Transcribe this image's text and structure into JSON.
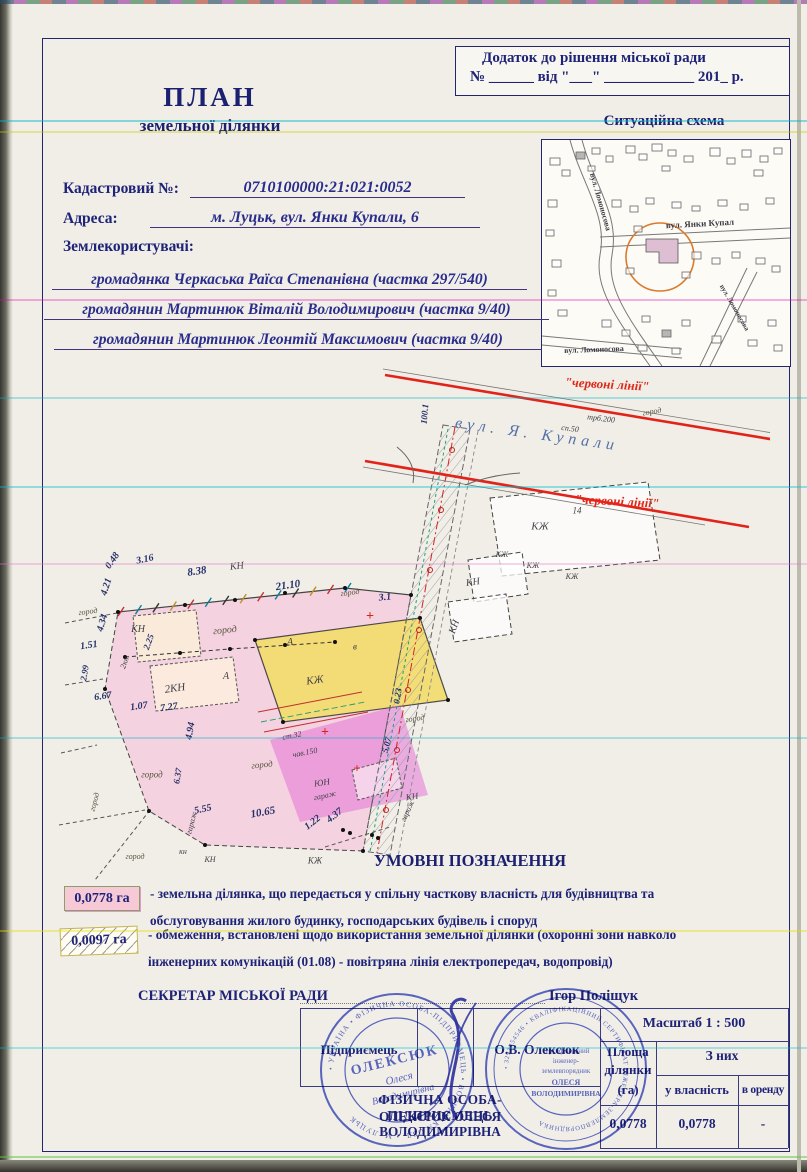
{
  "header": {
    "appendix_line1": "Додаток до рішення міської ради",
    "appendix_line2": "№ ______  від \"___\" ____________ 201_ р.",
    "title": "ПЛАН",
    "subtitle": "земельної ділянки"
  },
  "fields": {
    "cadastral_label": "Кадастровий №:",
    "cadastral_value": "0710100000:21:021:0052",
    "address_label": "Адреса:",
    "address_value": "м. Луцьк, вул. Янки Купали, 6",
    "users_label": "Землекористувачі:",
    "users": [
      "громадянка Черкаська Раїса Степанівна (частка 297/540)",
      "громадянин Мартинюк Віталій Володимирович (частка 9/40)",
      "громадянин Мартинюк Леонтій Максимович (частка 9/40)"
    ]
  },
  "scheme": {
    "title": "Ситуаційна схема",
    "labels": [
      {
        "t": "вул. Ломоносова",
        "x": 58,
        "y": 62,
        "r": 74,
        "s": 8,
        "c": "maplbl"
      },
      {
        "t": "вул. Янки Купал",
        "x": 158,
        "y": 84,
        "r": -3,
        "s": 9,
        "c": "maplbl"
      },
      {
        "t": "вул. Ломоносова",
        "x": 52,
        "y": 210,
        "r": -2,
        "s": 8,
        "c": "maplbl"
      },
      {
        "t": "вул. Ломоносова",
        "x": 192,
        "y": 168,
        "r": 60,
        "s": 7,
        "c": "maplbl"
      }
    ]
  },
  "plan": {
    "labels": [
      {
        "t": "вул. Я. Купали",
        "x": 492,
        "y": 80,
        "r": 8,
        "s": 16,
        "c": "street",
        "sp": 5
      },
      {
        "t": "\"червоні лінії\"",
        "x": 562,
        "y": 29,
        "r": 3,
        "s": 13,
        "c": "red"
      },
      {
        "t": "\"червоні лінії\"",
        "x": 572,
        "y": 146,
        "r": 3,
        "s": 13,
        "c": "red"
      },
      {
        "t": "100.1",
        "x": 380,
        "y": 59,
        "r": -85,
        "s": 9,
        "c": "dim"
      },
      {
        "t": "сп.50",
        "x": 525,
        "y": 74,
        "r": 7,
        "s": 8,
        "c": "lbl"
      },
      {
        "t": "трб.200",
        "x": 556,
        "y": 64,
        "r": 7,
        "s": 8,
        "c": "lbl"
      },
      {
        "t": "0.48",
        "x": 68,
        "y": 206,
        "r": -55,
        "s": 10,
        "c": "dim"
      },
      {
        "t": "3.16",
        "x": 100,
        "y": 205,
        "r": -12,
        "s": 10,
        "c": "dim"
      },
      {
        "t": "8.38",
        "x": 152,
        "y": 217,
        "r": -8,
        "s": 11,
        "c": "dim"
      },
      {
        "t": "4.21",
        "x": 62,
        "y": 232,
        "r": -72,
        "s": 10,
        "c": "dim"
      },
      {
        "t": "4.34",
        "x": 58,
        "y": 268,
        "r": -74,
        "s": 10,
        "c": "dim"
      },
      {
        "t": "21.10",
        "x": 243,
        "y": 231,
        "r": -8,
        "s": 11,
        "c": "dim"
      },
      {
        "t": "3.1",
        "x": 340,
        "y": 243,
        "r": -6,
        "s": 10,
        "c": "dim"
      },
      {
        "t": "КН",
        "x": 192,
        "y": 212,
        "r": -6,
        "s": 10,
        "c": "lbl"
      },
      {
        "t": "1.51",
        "x": 44,
        "y": 291,
        "r": -8,
        "s": 10,
        "c": "dim"
      },
      {
        "t": "2.25",
        "x": 104,
        "y": 287,
        "r": -70,
        "s": 9,
        "c": "dim"
      },
      {
        "t": "2.99",
        "x": 40,
        "y": 318,
        "r": -80,
        "s": 9,
        "c": "dim"
      },
      {
        "t": "6.67",
        "x": 58,
        "y": 342,
        "r": -8,
        "s": 10,
        "c": "dim"
      },
      {
        "t": "1.07",
        "x": 94,
        "y": 352,
        "r": -8,
        "s": 10,
        "c": "dim"
      },
      {
        "t": "7.27",
        "x": 124,
        "y": 353,
        "r": -8,
        "s": 10,
        "c": "dim"
      },
      {
        "t": "4.94",
        "x": 146,
        "y": 376,
        "r": -80,
        "s": 10,
        "c": "dim"
      },
      {
        "t": "6.37",
        "x": 133,
        "y": 421,
        "r": -80,
        "s": 9,
        "c": "dim"
      },
      {
        "t": "5.55",
        "x": 158,
        "y": 455,
        "r": -12,
        "s": 10,
        "c": "dim"
      },
      {
        "t": "10.65",
        "x": 218,
        "y": 458,
        "r": -10,
        "s": 11,
        "c": "dim"
      },
      {
        "t": "1.22",
        "x": 268,
        "y": 468,
        "r": -38,
        "s": 10,
        "c": "dim"
      },
      {
        "t": "4.37",
        "x": 290,
        "y": 461,
        "r": -38,
        "s": 10,
        "c": "dim"
      },
      {
        "t": "5.07",
        "x": 342,
        "y": 390,
        "r": -76,
        "s": 9,
        "c": "dim"
      },
      {
        "t": "0.23",
        "x": 353,
        "y": 341,
        "r": -80,
        "s": 9,
        "c": "dim"
      },
      {
        "t": "КН",
        "x": 93,
        "y": 275,
        "r": 0,
        "s": 10,
        "c": "lbl"
      },
      {
        "t": "2кн",
        "x": 80,
        "y": 308,
        "r": -70,
        "s": 8,
        "c": "lbl"
      },
      {
        "t": "2КН",
        "x": 130,
        "y": 334,
        "r": -8,
        "s": 11,
        "c": "lbl"
      },
      {
        "t": "А",
        "x": 245,
        "y": 288,
        "r": 0,
        "s": 10,
        "c": "lbl"
      },
      {
        "t": "в",
        "x": 310,
        "y": 292,
        "r": 0,
        "s": 9,
        "c": "lbl"
      },
      {
        "t": "А",
        "x": 181,
        "y": 322,
        "r": 0,
        "s": 10,
        "c": "lbl"
      },
      {
        "t": "КЖ",
        "x": 270,
        "y": 326,
        "r": -8,
        "s": 11,
        "c": "lbl"
      },
      {
        "t": "ст.32",
        "x": 247,
        "y": 381,
        "r": -11,
        "s": 8,
        "c": "lbl"
      },
      {
        "t": "чав.150",
        "x": 260,
        "y": 398,
        "r": -11,
        "s": 8,
        "c": "lbl"
      },
      {
        "t": "ЮН",
        "x": 277,
        "y": 428,
        "r": -8,
        "s": 9,
        "c": "lbl"
      },
      {
        "t": "город",
        "x": 43,
        "y": 257,
        "r": -8,
        "s": 8,
        "c": "grn"
      },
      {
        "t": "город",
        "x": 180,
        "y": 276,
        "r": -6,
        "s": 10,
        "c": "grn"
      },
      {
        "t": "город",
        "x": 305,
        "y": 238,
        "r": -8,
        "s": 8,
        "c": "grn"
      },
      {
        "t": "город",
        "x": 607,
        "y": 57,
        "r": -10,
        "s": 8,
        "c": "grn"
      },
      {
        "t": "город",
        "x": 370,
        "y": 364,
        "r": -8,
        "s": 8,
        "c": "grn"
      },
      {
        "t": "город",
        "x": 217,
        "y": 410,
        "r": -6,
        "s": 9,
        "c": "grn"
      },
      {
        "t": "город",
        "x": 107,
        "y": 420,
        "r": 0,
        "s": 9,
        "c": "grn"
      },
      {
        "t": "город",
        "x": 50,
        "y": 447,
        "r": -75,
        "s": 8,
        "c": "grn"
      },
      {
        "t": "город",
        "x": 90,
        "y": 502,
        "r": 0,
        "s": 8,
        "c": "grn"
      },
      {
        "t": "гараж",
        "x": 147,
        "y": 468,
        "r": -75,
        "s": 8,
        "c": "lbl"
      },
      {
        "t": "гараж",
        "x": 280,
        "y": 441,
        "r": -12,
        "s": 8,
        "c": "lbl"
      },
      {
        "t": "гараж",
        "x": 363,
        "y": 456,
        "r": -65,
        "s": 8,
        "c": "lbl"
      },
      {
        "t": "КН",
        "x": 367,
        "y": 442,
        "r": -8,
        "s": 9,
        "c": "lbl"
      },
      {
        "t": "кн",
        "x": 138,
        "y": 497,
        "r": 0,
        "s": 8,
        "c": "lbl"
      },
      {
        "t": "КН",
        "x": 165,
        "y": 505,
        "r": 0,
        "s": 8,
        "c": "lbl"
      },
      {
        "t": "КЖ",
        "x": 270,
        "y": 506,
        "r": 0,
        "s": 9,
        "c": "lbl"
      },
      {
        "t": "14",
        "x": 532,
        "y": 156,
        "r": 0,
        "s": 9,
        "c": "lbl"
      },
      {
        "t": "КН",
        "x": 428,
        "y": 228,
        "r": -8,
        "s": 10,
        "c": "lbl"
      },
      {
        "t": "КН",
        "x": 410,
        "y": 272,
        "r": -70,
        "s": 10,
        "c": "lbl"
      },
      {
        "t": "КЖ",
        "x": 495,
        "y": 172,
        "r": 0,
        "s": 11,
        "c": "lbl"
      },
      {
        "t": "КЖ",
        "x": 457,
        "y": 200,
        "r": 0,
        "s": 8,
        "c": "lbl"
      },
      {
        "t": "КЖ",
        "x": 488,
        "y": 211,
        "r": 0,
        "s": 8,
        "c": "lbl"
      },
      {
        "t": "КЖ",
        "x": 527,
        "y": 222,
        "r": 0,
        "s": 8,
        "c": "lbl"
      },
      {
        "t": "+",
        "x": 325,
        "y": 262,
        "r": 0,
        "s": 14,
        "c": "redx"
      },
      {
        "t": "+",
        "x": 280,
        "y": 378,
        "r": 0,
        "s": 14,
        "c": "redx"
      },
      {
        "t": "+",
        "x": 312,
        "y": 413,
        "r": 0,
        "s": 13,
        "c": "redx"
      }
    ]
  },
  "legend": {
    "title": "УМОВНІ ПОЗНАЧЕННЯ",
    "items": [
      {
        "value": "0,0778 га",
        "line1": "- земельна ділянка, що передається у спільну часткову власність для будівництва та",
        "line2": "обслуговування жилого будинку, господарських будівель і  споруд"
      },
      {
        "value": "0,0097 га",
        "line1": "- обмеження, встановлені щодо використання земельної ділянки (охоронні зони навколо",
        "line2": "інженерних комунікацій (01.08) - повітряна лінія електропередач, водопровід)"
      }
    ]
  },
  "signoff": {
    "secretary_label": "СЕКРЕТАР МІСЬКОЇ РАДИ",
    "secretary_name": "Ігор Поліщук"
  },
  "table": {
    "scale": "Масштаб 1 : 500",
    "entrepreneur_label": "Підприємець",
    "entrepreneur_name": "О.В. Олексюк",
    "area_l1": "Площа",
    "area_l2": "ділянки",
    "area_l3": "(га)",
    "of_them": "З них",
    "own": "у власність",
    "rent": "в оренду",
    "v_area": "0,0778",
    "v_own": "0,0778",
    "v_rent": "-"
  },
  "fop": {
    "line1": "ФІЗИЧНА ОСОБА-ПІДПРИЄМЕЦЬ",
    "line2": "ОЛЕКСЮК ОЛЕСЯ",
    "line3": "ВОЛОДИМИРІВНА"
  },
  "stamps": {
    "s1_ring": "• УКРАЇНА • ФІЗИЧНА ОСОБА-ПІДПРИЄМЕЦЬ • ВОЛИНСЬКА ОБЛ. • М. ЛУЦЬК",
    "s1_line1": "ОЛЕКСЮК",
    "s1_line2": "Олеся",
    "s1_line3": "Володимирівна",
    "s2_ring": "• 3293454546 • КВАЛІФІКАЦІЙНИЙ СЕРТИФІКАТ ІНЖЕНЕРА-ЗЕМЛЕВПОРЯДНИКА",
    "s2_lines": [
      "сертифікований",
      "інженер-",
      "землевпорядник",
      "ОЛЕСЯ",
      "ВОЛОДИМИРІВНА"
    ]
  }
}
